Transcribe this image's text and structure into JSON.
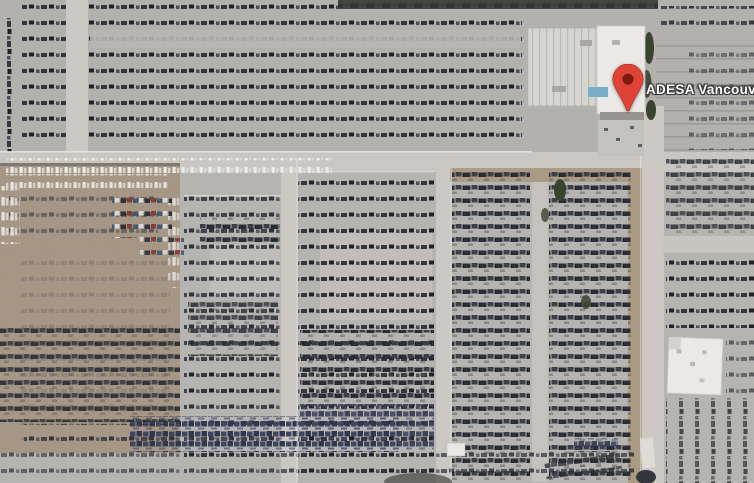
{
  "place": {
    "name": "ADESA Vancouv"
  },
  "marker": {
    "icon": "map-pin-icon",
    "pin_color": "#DF4335",
    "dot_color": "#7E1B10",
    "outline_color": "#B03024"
  },
  "label": {
    "text_color": "#FFFFFF",
    "outline_color": "#3C3C3C"
  },
  "imagery": {
    "base_pavement_color": "#B6B4B1",
    "road_color": "#CCC9C5",
    "dirt_color": "#A3927F",
    "roof_color": "#EBE9E6",
    "teal_awning_color": "#7AAEC6",
    "vegetation_color": "#3A4330",
    "dark_car_color": "#2E3137",
    "white_car_color": "#ECECE9",
    "blue_car_color": "#3E4660"
  }
}
